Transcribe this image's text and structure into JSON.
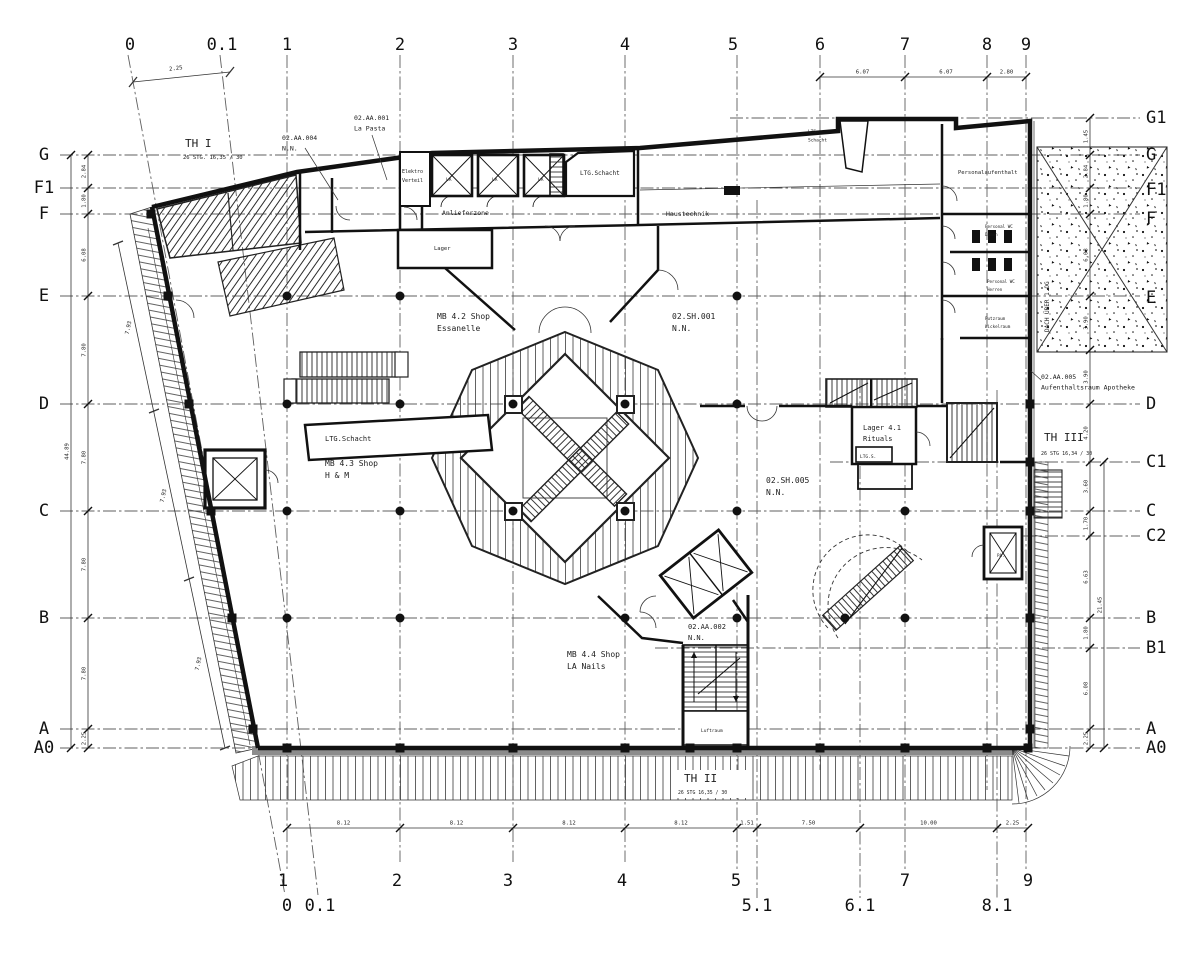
{
  "drawing": {
    "grid": {
      "h_lines": [
        {
          "y": 118,
          "x1": 730,
          "x2": 1140
        },
        {
          "y": 155,
          "x1": 60,
          "x2": 1140
        },
        {
          "y": 188,
          "x1": 60,
          "x2": 1140
        },
        {
          "y": 214,
          "x1": 60,
          "x2": 1140
        },
        {
          "y": 296,
          "x1": 60,
          "x2": 1140
        },
        {
          "y": 404,
          "x1": 60,
          "x2": 1140
        },
        {
          "y": 462,
          "x1": 830,
          "x2": 1140
        },
        {
          "y": 511,
          "x1": 60,
          "x2": 1140
        },
        {
          "y": 536,
          "x1": 1002,
          "x2": 1140
        },
        {
          "y": 618,
          "x1": 60,
          "x2": 1140
        },
        {
          "y": 648,
          "x1": 655,
          "x2": 1140
        },
        {
          "y": 729,
          "x1": 60,
          "x2": 1140
        },
        {
          "y": 748,
          "x1": 60,
          "x2": 1140
        }
      ],
      "v_lines": [
        {
          "x": 287,
          "y1": 55,
          "y2": 872
        },
        {
          "x": 400,
          "y1": 55,
          "y2": 862
        },
        {
          "x": 513,
          "y1": 55,
          "y2": 862
        },
        {
          "x": 625,
          "y1": 55,
          "y2": 862
        },
        {
          "x": 737,
          "y1": 55,
          "y2": 872
        },
        {
          "x": 757,
          "y1": 200,
          "y2": 898
        },
        {
          "x": 820,
          "y1": 55,
          "y2": 770
        },
        {
          "x": 860,
          "y1": 380,
          "y2": 898
        },
        {
          "x": 905,
          "y1": 55,
          "y2": 872
        },
        {
          "x": 987,
          "y1": 55,
          "y2": 790
        },
        {
          "x": 997,
          "y1": 390,
          "y2": 898
        },
        {
          "x": 1026,
          "y1": 55,
          "y2": 872
        },
        {
          "x": 128,
          "y1": 55,
          "x2": 285,
          "y2": 895
        },
        {
          "x": 220,
          "y1": 55,
          "x2": 318,
          "y2": 895
        }
      ],
      "col_labels_top": [
        [
          "0",
          130
        ],
        [
          "0.1",
          222
        ],
        [
          "1",
          287
        ],
        [
          "2",
          400
        ],
        [
          "3",
          513
        ],
        [
          "4",
          625
        ],
        [
          "5",
          733
        ],
        [
          "6",
          820
        ],
        [
          "7",
          905
        ],
        [
          "8",
          987
        ],
        [
          "9",
          1026
        ]
      ],
      "col_labels_bottom": [
        [
          "1",
          283,
          886
        ],
        [
          "2",
          397,
          886
        ],
        [
          "3",
          508,
          886
        ],
        [
          "4",
          622,
          886
        ],
        [
          "5",
          736,
          886
        ],
        [
          "7",
          905,
          886
        ],
        [
          "9",
          1028,
          886
        ],
        [
          "0",
          287,
          911
        ],
        [
          "0.1",
          320,
          911
        ],
        [
          "5.1",
          757,
          911
        ],
        [
          "6.1",
          860,
          911
        ],
        [
          "8.1",
          997,
          911
        ]
      ],
      "row_labels_left": [
        [
          "G",
          155
        ],
        [
          "F1",
          188
        ],
        [
          "F",
          214
        ],
        [
          "E",
          296
        ],
        [
          "D",
          404
        ],
        [
          "C",
          511
        ],
        [
          "B",
          618
        ],
        [
          "A",
          729
        ],
        [
          "A0",
          748
        ]
      ],
      "row_labels_right": [
        [
          "G1",
          118
        ],
        [
          "G",
          155
        ],
        [
          "F1",
          190
        ],
        [
          "F",
          219
        ],
        [
          "E",
          298
        ],
        [
          "D",
          404
        ],
        [
          "C1",
          462
        ],
        [
          "C",
          511
        ],
        [
          "C2",
          536
        ],
        [
          "B",
          618
        ],
        [
          "B1",
          648
        ],
        [
          "A",
          729
        ],
        [
          "A0",
          748
        ]
      ]
    },
    "dimensions": {
      "chains": [
        {
          "o": "h",
          "y": 828,
          "ticks": [
            287,
            400,
            513,
            625,
            737,
            757,
            860,
            997,
            1028
          ],
          "labels": [
            "8.12",
            "8.12",
            "8.12",
            "8.12",
            "1.51",
            "7.50",
            "10.00",
            "2.25"
          ]
        },
        {
          "o": "h",
          "y": 77,
          "ticks": [
            820,
            905,
            987,
            1026
          ],
          "labels": [
            "6.07",
            "6.07",
            "2.80"
          ]
        },
        {
          "o": "v",
          "x": 88,
          "ticks": [
            155,
            188,
            214,
            296,
            404,
            511,
            618,
            729,
            748
          ],
          "labels": [
            "2.84",
            "1.80",
            "6.08",
            "7.80",
            "7.80",
            "7.80",
            "7.80",
            "2.25"
          ]
        },
        {
          "o": "v",
          "x": 71,
          "ticks": [
            155,
            748
          ],
          "labels": [
            "44.89"
          ]
        },
        {
          "o": "v",
          "x": 1090,
          "ticks": [
            118,
            155,
            188,
            214,
            296,
            350,
            404,
            462,
            511,
            536,
            618,
            648,
            729,
            748
          ],
          "labels": [
            "1.45",
            "2.84",
            "1.80",
            "6.08",
            "3.90",
            "3.90",
            "4.20",
            "3.60",
            "1.70",
            "6.63",
            "1.80",
            "6.08",
            "2.25"
          ]
        },
        {
          "o": "v",
          "x": 1104,
          "ticks": [
            462,
            748
          ],
          "labels": [
            "21.45"
          ]
        }
      ],
      "rotated": [
        {
          "t": "2.25",
          "x": 176,
          "y": 70,
          "rot": -7
        },
        {
          "t": "7.93",
          "x": 130,
          "y": 328,
          "rot": -78
        },
        {
          "t": "7.93",
          "x": 165,
          "y": 496,
          "rot": -78
        },
        {
          "t": "7.93",
          "x": 200,
          "y": 664,
          "rot": -78
        }
      ]
    },
    "labels": [
      {
        "lines": [
          "TH I"
        ],
        "x": 185,
        "y": 147,
        "s": 11
      },
      {
        "lines": [
          "26 STG. 16,35 / 30"
        ],
        "x": 183,
        "y": 159,
        "s": 5.5
      },
      {
        "lines": [
          "02.AA.004",
          "N.N."
        ],
        "x": 282,
        "y": 140,
        "s": 6.5
      },
      {
        "lines": [
          "02.AA.001",
          "La Pasta"
        ],
        "x": 354,
        "y": 120,
        "s": 6.5
      },
      {
        "lines": [
          "Elektro",
          "Verteil"
        ],
        "x": 402,
        "y": 173,
        "s": 5
      },
      {
        "lines": [
          "LA"
        ],
        "x": 446,
        "y": 181,
        "s": 4.5
      },
      {
        "lines": [
          "LA"
        ],
        "x": 492,
        "y": 181,
        "s": 4.5
      },
      {
        "lines": [
          "LA"
        ],
        "x": 538,
        "y": 181,
        "s": 4.5
      },
      {
        "lines": [
          "LTG.Schacht"
        ],
        "x": 580,
        "y": 175,
        "s": 6
      },
      {
        "lines": [
          "Anlieferzone"
        ],
        "x": 442,
        "y": 215,
        "s": 6.5
      },
      {
        "lines": [
          "Haustechnik"
        ],
        "x": 666,
        "y": 216,
        "s": 6.5
      },
      {
        "lines": [
          "Lager"
        ],
        "x": 434,
        "y": 250,
        "s": 5.5
      },
      {
        "lines": [
          "LTG.",
          "Schacht"
        ],
        "x": 808,
        "y": 133,
        "s": 4.5
      },
      {
        "lines": [
          "Personalaufenthalt"
        ],
        "x": 958,
        "y": 174,
        "s": 5.5
      },
      {
        "lines": [
          "Personal WC",
          "Damen"
        ],
        "x": 985,
        "y": 228,
        "s": 4.2
      },
      {
        "lines": [
          "Personal WC",
          "Herren"
        ],
        "x": 987,
        "y": 283,
        "s": 4.2
      },
      {
        "lines": [
          "Putzraum",
          "Wickelraum"
        ],
        "x": 985,
        "y": 320,
        "s": 4.2
      },
      {
        "lines": [
          "LTG.Schacht"
        ],
        "x": 325,
        "y": 441,
        "s": 7
      },
      {
        "lines": [
          "MB 4.2 Shop",
          "Essanelle"
        ],
        "x": 437,
        "y": 319,
        "s": 8
      },
      {
        "lines": [
          "02.SH.001",
          "N.N."
        ],
        "x": 672,
        "y": 319,
        "s": 8
      },
      {
        "lines": [
          "MB 4.3 Shop",
          "H & M"
        ],
        "x": 325,
        "y": 466,
        "s": 8
      },
      {
        "lines": [
          "02.SH.005",
          "N.N."
        ],
        "x": 766,
        "y": 483,
        "s": 8
      },
      {
        "lines": [
          "MB 4.4 Shop",
          "LA Nails"
        ],
        "x": 567,
        "y": 657,
        "s": 8
      },
      {
        "lines": [
          "02.AA.002",
          "N.N."
        ],
        "x": 688,
        "y": 629,
        "s": 7
      },
      {
        "lines": [
          "Lager 4.1",
          "Rituals"
        ],
        "x": 863,
        "y": 430,
        "s": 7
      },
      {
        "lines": [
          "LTG.S."
        ],
        "x": 860,
        "y": 458,
        "s": 4.5
      },
      {
        "lines": [
          "02.AA.005",
          "Aufenthaltsraum Apotheke"
        ],
        "x": 1041,
        "y": 379,
        "s": 6.5
      },
      {
        "lines": [
          "TH III"
        ],
        "x": 1044,
        "y": 441,
        "s": 11
      },
      {
        "lines": [
          "26 STG 16,34 / 30"
        ],
        "x": 1041,
        "y": 455,
        "s": 5
      },
      {
        "lines": [
          "TH II"
        ],
        "x": 684,
        "y": 782,
        "s": 11
      },
      {
        "lines": [
          "26 STG 16,35 / 30"
        ],
        "x": 678,
        "y": 794,
        "s": 4.8
      },
      {
        "lines": [
          "Luftraum"
        ],
        "x": 701,
        "y": 732,
        "s": 4.5
      },
      {
        "lines": [
          "DACH ÜBER 1.OG"
        ],
        "x": 1049,
        "y": 332,
        "s": 6,
        "rot": -90
      },
      {
        "lines": [
          "PA."
        ],
        "x": 997,
        "y": 557,
        "s": 4.2
      }
    ],
    "columns": {
      "dots": [
        [
          287,
          296
        ],
        [
          400,
          296
        ],
        [
          737,
          296
        ],
        [
          287,
          404
        ],
        [
          400,
          404
        ],
        [
          513,
          404
        ],
        [
          625,
          404
        ],
        [
          737,
          404
        ],
        [
          287,
          511
        ],
        [
          400,
          511
        ],
        [
          513,
          511
        ],
        [
          625,
          511
        ],
        [
          737,
          511
        ],
        [
          905,
          511
        ],
        [
          287,
          618
        ],
        [
          400,
          618
        ],
        [
          625,
          618
        ],
        [
          737,
          618
        ],
        [
          845,
          618
        ],
        [
          905,
          618
        ]
      ],
      "squares": [
        [
          287,
          748
        ],
        [
          400,
          748
        ],
        [
          513,
          748
        ],
        [
          625,
          748
        ],
        [
          690,
          748
        ],
        [
          737,
          748
        ],
        [
          820,
          748
        ],
        [
          905,
          748
        ],
        [
          987,
          748
        ],
        [
          1028,
          748
        ],
        [
          1030,
          404
        ],
        [
          1030,
          462
        ],
        [
          1030,
          511
        ],
        [
          1030,
          618
        ],
        [
          1030,
          729
        ],
        [
          151,
          214
        ],
        [
          168,
          296
        ],
        [
          189,
          404
        ],
        [
          211,
          511
        ],
        [
          232,
          618
        ],
        [
          253,
          729
        ]
      ]
    }
  }
}
